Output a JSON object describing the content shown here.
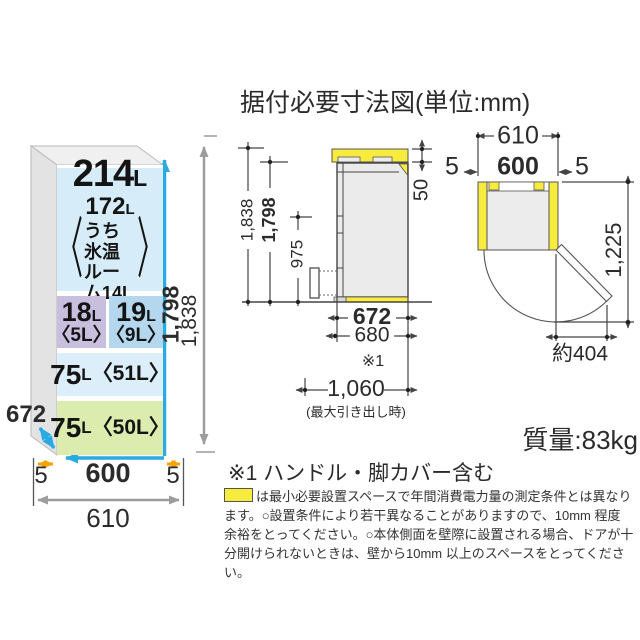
{
  "title": "据付必要寸法図(単位:mm)",
  "front_view": {
    "top_comp": {
      "num": "214",
      "unit": "L",
      "sub_num": "172",
      "sub_unit": "L",
      "line3": "うち氷温",
      "line4": "ルーム14L",
      "bracket_l": "〈",
      "bracket_r": "〉"
    },
    "comp_18": {
      "num": "18",
      "unit": "L",
      "sub": "〈5L〉"
    },
    "comp_19": {
      "num": "19",
      "unit": "L",
      "sub": "〈9L〉"
    },
    "comp_75a": {
      "num": "75",
      "unit": "L",
      "sub": "〈51L〉"
    },
    "comp_75b": {
      "num": "75",
      "unit": "L",
      "sub": "〈50L〉"
    },
    "dim_depth": "672",
    "dim_width": "600",
    "dim_width_total": "610",
    "dim_gap_left": "5",
    "dim_gap_right": "5",
    "dim_height": "1,798",
    "dim_height_total": "1,838"
  },
  "side_view": {
    "dim_height_total": "1,838",
    "dim_height": "1,798",
    "dim_handle": "975",
    "dim_clearance_top": "50",
    "dim_depth": "672",
    "dim_depth_handle": "680",
    "ref": "※1",
    "dim_drawer": "1,060",
    "drawer_note": "(最大引き出し時)"
  },
  "top_view": {
    "dim_width_total": "610",
    "dim_gap_left": "5",
    "dim_width": "600",
    "dim_gap_right": "5",
    "dim_door_depth": "1,225",
    "dim_door_swing": "約404"
  },
  "weight": "質量:83kg",
  "footnote_ref": "※1 ハンドル・脚カバー含む",
  "legend_lines": [
    "は最小必要設置スペースで年間消費電力量の測定条件とは異なり",
    "ます。○設置条件により若干異なることがありますので、10mm 程度",
    "余裕をとってください。○本体側面を壁際に設置される場合、ドアが十",
    "分開けられないときは、壁から10mm 以上のスペースをとってください。"
  ],
  "colors": {
    "cyan": "#29abe2",
    "orange": "#f5a300",
    "yellow": "#f7ec3e",
    "gray_arrow": "#9c9c9c",
    "comp_top": "#d6ecf8",
    "comp_purple": "#c8bfde",
    "comp_blue": "#b4d7ee",
    "comp_pale": "#dceefa",
    "comp_green": "#dcebae"
  }
}
